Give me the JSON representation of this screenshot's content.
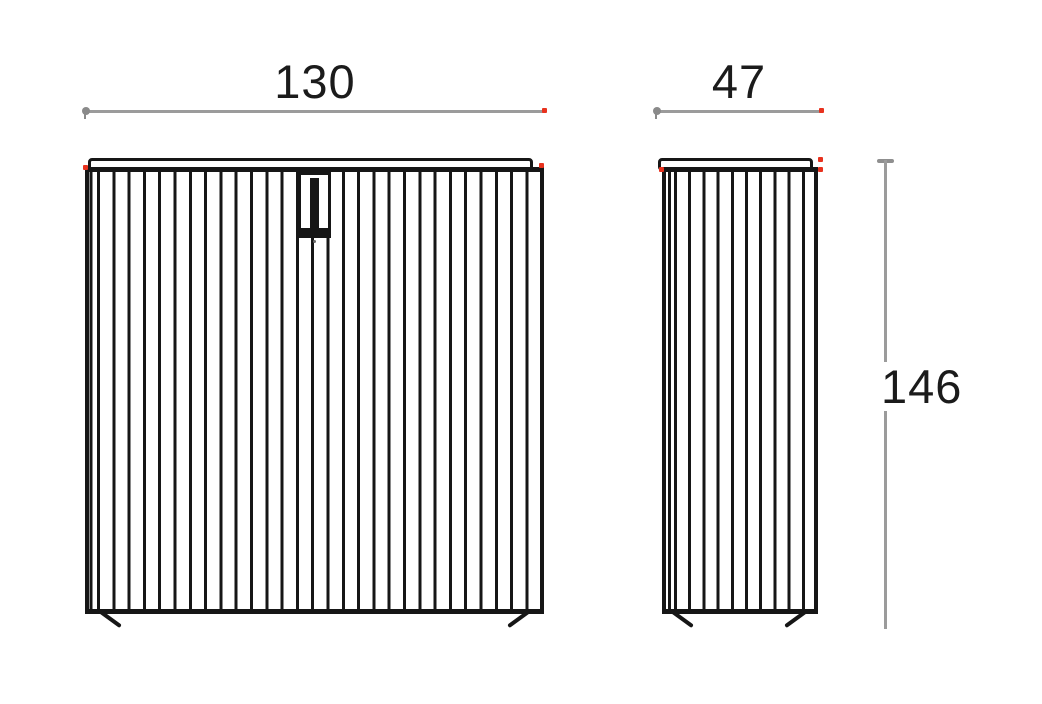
{
  "drawing": {
    "type": "furniture-technical-drawing",
    "views": [
      {
        "id": "front",
        "description": "front elevation with slatted doors and pull handle"
      },
      {
        "id": "side",
        "description": "side elevation with slats"
      }
    ],
    "dimensions": {
      "width_label": "130",
      "depth_label": "47",
      "height_label": "146"
    },
    "colors": {
      "line": "#161616",
      "dimension_line": "#9b9b9b",
      "marker": "#e8321e",
      "text": "#1b1b1b",
      "background": "#ffffff"
    }
  }
}
